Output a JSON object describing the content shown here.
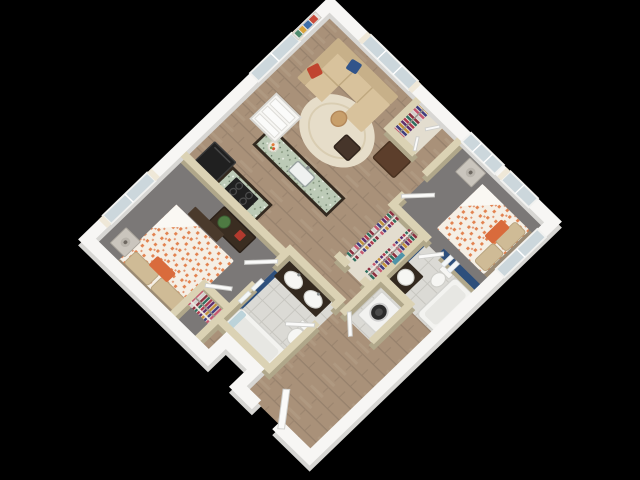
{
  "scene": {
    "title": "3D isometric floor plan of a two-bedroom, two-bathroom apartment",
    "view": "isometric top-down, rotated 45 degrees",
    "background": "#000000"
  },
  "palette": {
    "background": "#000000",
    "wall_exterior_top": "#f7f6f4",
    "wall_exterior_base": "#d7d6d3",
    "wall_interior_top": "#dbd2b4",
    "wall_interior_base": "#b0a78a",
    "wood_floor": "#a99179",
    "wood_plank_line": "#96816c",
    "carpet_gray": "#7b7877",
    "tile_light": "#dbdad5",
    "granite_green": "#bccab6",
    "accent_navy": "#2d4f7c",
    "sofa_tan": "#d8c29c",
    "sofa_back_tan": "#c7b089",
    "pillow_red": "#c0452f",
    "pillow_blue": "#31548a",
    "rug_cream": "#e6ddc9",
    "cabinet_espresso": "#33291f",
    "appliance_black": "#202020",
    "duvet_base": "#f5efe5",
    "duvet_orange": "#e2824f",
    "pillow_tan": "#cfbb96",
    "accent_pillow_orange": "#d96b3c",
    "fixture_white": "#f6f6f3",
    "washer_white": "#f2f2f0",
    "window_glass": "#ccd7dc",
    "curtain_ivory": "#efe8d8",
    "door_white": "#fafaf9",
    "wall_art_colors": [
      "#c84b3a",
      "#3f6fa8",
      "#d8a43c",
      "#4f8a6e"
    ],
    "clothes_colors": [
      "#b03a4e",
      "#5d2f6e",
      "#c2913a",
      "#3f3d7d",
      "#c4576e",
      "#8c2f3f",
      "#d0cfcd",
      "#2f6e5e"
    ]
  },
  "rooms": [
    {
      "id": "living-room",
      "label": "Living Room",
      "floor": "wood plank",
      "furniture": [
        "tan L-shaped sectional sofa with chaise",
        "red accent pillow",
        "blue accent pillow",
        "round cream area rug",
        "dark wood side table",
        "round tan stool",
        "colorful abstract wall art",
        "two curtained windows"
      ]
    },
    {
      "id": "kitchen",
      "label": "Kitchen",
      "floor": "wood plank",
      "furniture": [
        "island with green speckled granite top and espresso base",
        "undermount sink with faucet",
        "fruit bowl",
        "espresso counter with black cooktop",
        "black refrigerator"
      ]
    },
    {
      "id": "pantry",
      "label": "Pantry Closet",
      "floor": "white",
      "furniture": [
        "white shelving"
      ]
    },
    {
      "id": "hall-closet",
      "label": "Hall Closet",
      "floor": "light",
      "furniture": [
        "rod of multicolor hanging clothes",
        "white bifold doors"
      ]
    },
    {
      "id": "bedroom-1",
      "label": "Bedroom 1",
      "floor": "gray carpet",
      "furniture": [
        "bed with orange patterned duvet",
        "tan pillows",
        "orange accent pillow",
        "nightstand with lamp",
        "foot bench",
        "espresso dresser with plant and red decor",
        "curtained window"
      ]
    },
    {
      "id": "bedroom-1-closet",
      "label": "Bedroom 1 Closet",
      "floor": "gray carpet",
      "furniture": [
        "rod of multicolor hanging clothes",
        "open white door"
      ]
    },
    {
      "id": "bathroom-1",
      "label": "Bathroom 1",
      "floor": "light tile",
      "furniture": [
        "double-sink espresso vanity",
        "toilet",
        "bathtub",
        "navy accent wall",
        "white towels"
      ]
    },
    {
      "id": "bedroom-2",
      "label": "Bedroom 2",
      "floor": "gray carpet",
      "furniture": [
        "bed with orange patterned duvet",
        "tan pillows",
        "orange accent pillow",
        "nightstand with lamp",
        "curtained windows"
      ]
    },
    {
      "id": "walk-in-closet",
      "label": "Walk-in Closet",
      "floor": "light",
      "furniture": [
        "two rods of multicolor hanging clothes"
      ]
    },
    {
      "id": "bathroom-2",
      "label": "Bathroom 2",
      "floor": "light tile",
      "furniture": [
        "vanity with sink",
        "toilet",
        "bathtub",
        "navy accent wall with white towels"
      ]
    },
    {
      "id": "laundry",
      "label": "Laundry Closet",
      "floor": "light tile",
      "furniture": [
        "white front-load washer with dark round door",
        "open white door"
      ]
    },
    {
      "id": "hallway",
      "label": "Hallway",
      "floor": "wood plank",
      "furniture": [
        "dark wood media chest"
      ]
    },
    {
      "id": "entry",
      "label": "Entry",
      "floor": "wood plank",
      "furniture": [
        "open white entry door"
      ]
    }
  ]
}
